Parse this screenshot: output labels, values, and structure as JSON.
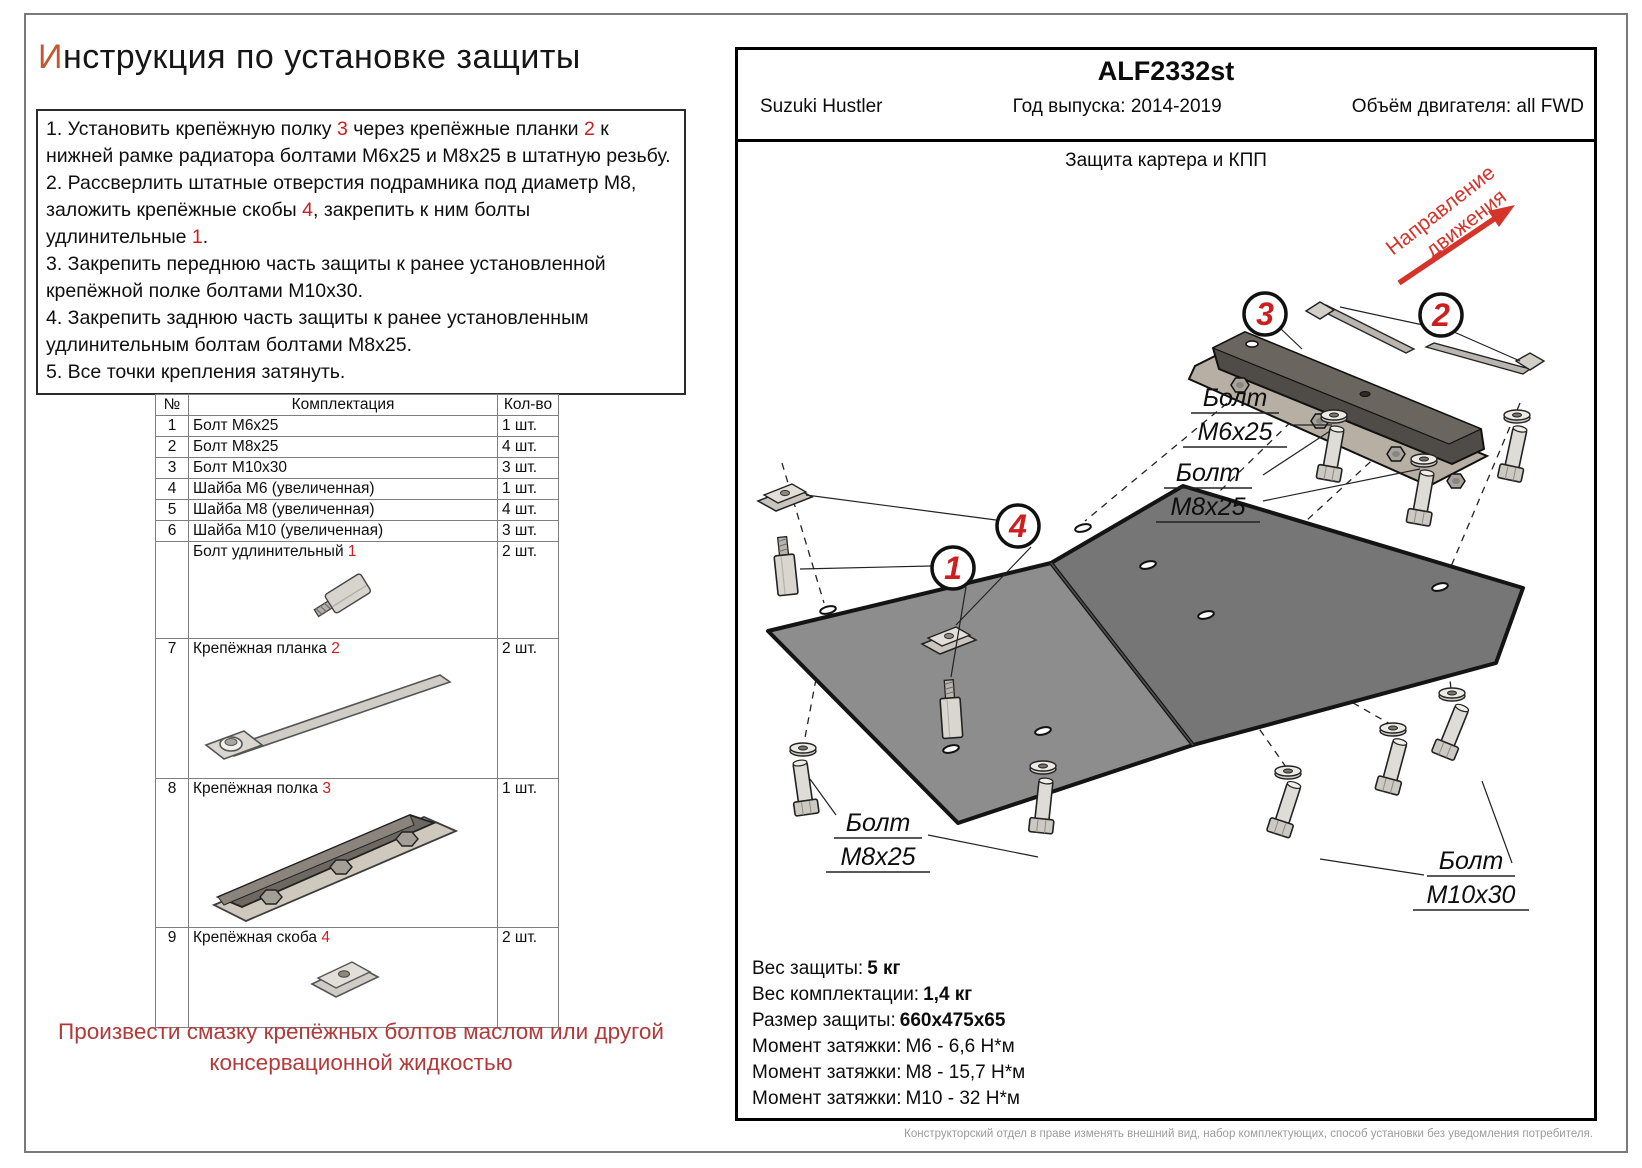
{
  "colors": {
    "accent_letter": "#C3572F",
    "ref_red": "#CC2020",
    "note_red": "#B23A3A",
    "direction_red": "#D5342B"
  },
  "title": {
    "lead": "И",
    "rest": "нструкция по установке защиты"
  },
  "instructions": {
    "items": [
      [
        {
          "t": "1. Установить крепёжную полку "
        },
        {
          "t": "3",
          "red": true
        },
        {
          "t": " через крепёжные планки "
        },
        {
          "t": "2",
          "red": true
        },
        {
          "t": " к нижней рамке радиатора болтами М6х25 и М8х25 в штатную резьбу."
        }
      ],
      [
        {
          "t": "2. Рассверлить штатные отверстия подрамника под диаметр М8, заложить крепёжные скобы "
        },
        {
          "t": "4",
          "red": true
        },
        {
          "t": ", закрепить к ним болты удлинительные "
        },
        {
          "t": "1",
          "red": true
        },
        {
          "t": "."
        }
      ],
      [
        {
          "t": "3. Закрепить переднюю часть защиты к ранее установленной крепёжной полке болтами М10х30."
        }
      ],
      [
        {
          "t": "4. Закрепить заднюю часть защиты к ранее установленным удлинительным болтам болтами М8х25."
        }
      ],
      [
        {
          "t": "5. Все точки крепления затянуть."
        }
      ]
    ]
  },
  "parts_table": {
    "headers": {
      "num": "№",
      "name": "Комплектация",
      "qty": "Кол-во"
    },
    "rows": [
      {
        "num": "1",
        "name": "Болт М6х25",
        "qty": "1 шт."
      },
      {
        "num": "2",
        "name": "Болт М8х25",
        "qty": "4 шт."
      },
      {
        "num": "3",
        "name": "Болт М10х30",
        "qty": "3 шт."
      },
      {
        "num": "4",
        "name": "Шайба М6 (увеличенная)",
        "qty": "1 шт."
      },
      {
        "num": "5",
        "name": "Шайба М8 (увеличенная)",
        "qty": "4 шт."
      },
      {
        "num": "6",
        "name": "Шайба М10 (увеличенная)",
        "qty": "3 шт."
      },
      {
        "num": "",
        "name": "Болт удлинительный ",
        "ref": "1",
        "qty": "2 шт.",
        "image": "standoff",
        "h": 97
      },
      {
        "num": "7",
        "name": "Крепёжная планка ",
        "ref": "2",
        "qty": "2 шт.",
        "image": "strip",
        "h": 140
      },
      {
        "num": "8",
        "name": "Крепёжная полка ",
        "ref": "3",
        "qty": "1 шт.",
        "image": "shelf",
        "h": 147
      },
      {
        "num": "9",
        "name": "Крепёжная скоба ",
        "ref": "4",
        "qty": "2 шт.",
        "image": "clamp",
        "h": 100
      }
    ]
  },
  "note": {
    "text": "Произвести смазку крепёжных болтов маслом или другой консервационной жидкостью"
  },
  "panel": {
    "code": "ALF2332st",
    "vehicle": "Suzuki Hustler",
    "year": "Год выпуска: 2014-2019",
    "engine": "Объём двигателя: all FWD",
    "drawing_title": "Защита картера и КПП",
    "direction_line1": "Направление",
    "direction_line2": "движения",
    "callout_1": "1",
    "callout_2": "2",
    "callout_3": "3",
    "callout_4": "4",
    "label_bolt": "Болт",
    "label_m6x25": "М6х25",
    "label_m8x25": "М8х25",
    "label_m10x30": "М10х30",
    "specs": [
      {
        "label": "Вес защиты:",
        "value": "5 кг",
        "bold": true
      },
      {
        "label": "Вес комплектации:",
        "value": "1,4 кг",
        "bold": true
      },
      {
        "label": "Размер защиты:",
        "value": "660х475х65",
        "bold": true
      },
      {
        "label": "Момент затяжки:",
        "value": "М6 - 6,6 Н*м",
        "bold": false
      },
      {
        "label": "Момент затяжки:",
        "value": "М8 - 15,7 Н*м",
        "bold": false
      },
      {
        "label": "Момент затяжки:",
        "value": "М10 - 32 Н*м",
        "bold": false
      }
    ]
  },
  "footer_note": "Конструкторский отдел в праве изменять внешний вид, набор комплектующих, способ установки без уведомления потребителя."
}
